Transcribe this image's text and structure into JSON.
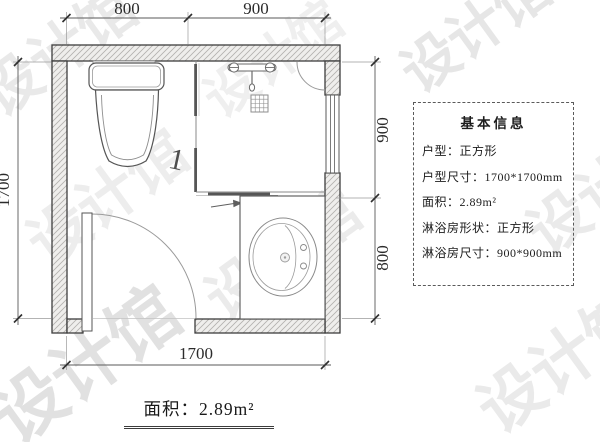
{
  "watermark": {
    "text": "设计馆",
    "color": "#e4e4e4"
  },
  "plan": {
    "annotation_door_mark": "1",
    "dims": {
      "top_segment_1": "800",
      "top_segment_2": "900",
      "left_total": "1700",
      "right_segment_1": "900",
      "right_segment_2": "800",
      "bottom_total": "1700"
    }
  },
  "info_box": {
    "title": "基本信息",
    "rows": [
      "户型：正方形",
      "户型尺寸：1700*1700mm",
      "面积：2.89m²",
      "淋浴房形状：正方形",
      "淋浴房尺寸：900*900mm"
    ]
  },
  "footer": {
    "area_label": "面积：2.89m²"
  }
}
